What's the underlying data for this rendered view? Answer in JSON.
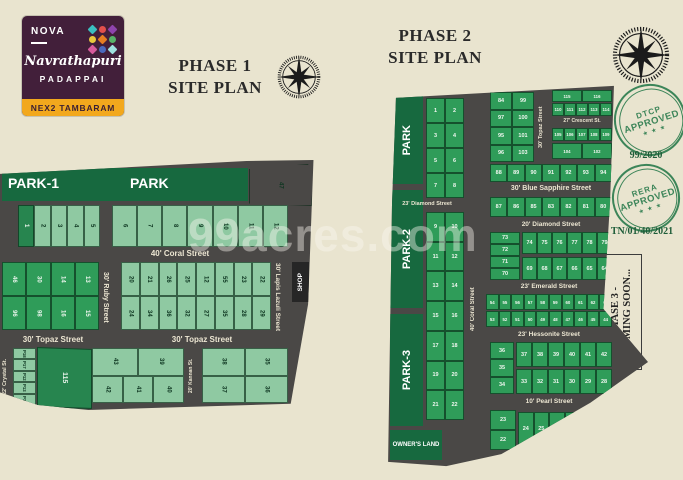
{
  "page": {
    "watermark": "99acres.com"
  },
  "colors": {
    "background": "#e9e4cf",
    "road": "#4a4846",
    "park_green": "#17693f",
    "plot_light": "#8fc9a2",
    "plot_mid": "#2f9c59",
    "plot_dark": "#27854f",
    "stamp_green": "#2e7d4f",
    "logo_bg": "#421f3a",
    "logo_banner": "#f2a81d"
  },
  "logo": {
    "brand": "NOVA",
    "name": "Navrathapuri",
    "location": "PADAPPAI",
    "banner": "NEX2 TAMBARAM",
    "gems": [
      "#3bbfc0",
      "#e2504c",
      "#8e44ad",
      "#e9c93d",
      "#e67e22",
      "#58b368",
      "#d85a9c",
      "#4a69bd",
      "#9fe3e0"
    ]
  },
  "titles": {
    "phase1_line1": "PHASE 1",
    "phase1_line2": "SITE PLAN",
    "phase2_line1": "PHASE 2",
    "phase2_line2": "SITE PLAN"
  },
  "approvals": {
    "dtcp": {
      "top": "DTCP",
      "mid": "APPROVED",
      "stars": "★ ★ ★",
      "number": "99/2020"
    },
    "rera": {
      "top": "RERA",
      "mid": "APPROVED",
      "stars": "★ ★ ★",
      "number": "TN/01/40/2021"
    }
  },
  "phase3_banner": {
    "line1": "PHASE 3 -",
    "line2": "COMING SOON..."
  },
  "phase1": {
    "park1_label": "PARK-1",
    "park_label": "PARK",
    "corner_plot": "47",
    "shop_label": "SHOP",
    "streets": {
      "coral": "40' Coral Street",
      "ruby": "30' Ruby Street",
      "lapis": "30' Lapis Lazuli Street",
      "topaz": "30' Topaz Street",
      "topaz_left": "30' Topaz Street",
      "crystal": "22' Crystal St.",
      "kannan": "20' Kannan St."
    },
    "row_top_a": [
      "1",
      "2",
      "3",
      "4",
      "5"
    ],
    "row_top_b": [
      "6",
      "7",
      "8",
      "9",
      "10",
      "11",
      "12"
    ],
    "block_left": [
      [
        "46",
        "30",
        "14",
        "13"
      ],
      [
        "96",
        "98",
        "16",
        "15"
      ]
    ],
    "block_center": [
      [
        "20",
        "21",
        "26",
        "25",
        "12",
        "55",
        "23",
        "22"
      ],
      [
        "24",
        "34",
        "36",
        "32",
        "27",
        "35",
        "28",
        "29"
      ]
    ],
    "tiny_col": [
      "P18",
      "P17",
      "P12",
      "P13",
      "P14"
    ],
    "plot_115": "115",
    "block_bl": [
      [
        "43",
        "39"
      ],
      [
        "42",
        "41",
        "40"
      ]
    ],
    "block_br": [
      [
        "38",
        "35"
      ],
      [
        "37",
        "36"
      ]
    ]
  },
  "phase2": {
    "parks": [
      "PARK",
      "PARK-2",
      "PARK-3"
    ],
    "owners_land": "OWNER'S LAND",
    "shop_label": "SHOP",
    "streets": {
      "topaz": "30' Topaz Street",
      "crescent": "27' Crescent St.",
      "blue_sapphire": "30' Blue Sapphire Street",
      "diamond_small": "23' Diamond Street",
      "diamond": "20' Diamond Street",
      "emerald": "23' Emerald Street",
      "hessonite": "23' Hessonite Street",
      "pearl": "10' Pearl Street",
      "coral": "40' Coral Street"
    },
    "col_left_upper": [
      [
        "1",
        "2"
      ],
      [
        "3",
        "4"
      ],
      [
        "5",
        "6"
      ],
      [
        "7",
        "8"
      ]
    ],
    "col_left_lower": [
      [
        "9",
        "10"
      ],
      [
        "11",
        "12"
      ],
      [
        "13",
        "14"
      ],
      [
        "15",
        "16"
      ],
      [
        "17",
        "18"
      ],
      [
        "19",
        "20"
      ],
      [
        "21",
        "22"
      ]
    ],
    "block_top_left": [
      [
        "84",
        "99"
      ],
      [
        "97",
        "100"
      ],
      [
        "95",
        "101"
      ],
      [
        "96",
        "103"
      ]
    ],
    "row_115": [
      "115",
      "116"
    ],
    "row_110": [
      "110",
      "111",
      "112",
      "113",
      "114"
    ],
    "row_105": [
      "105",
      "106",
      "107",
      "108",
      "109"
    ],
    "row_104": [
      "104",
      "102"
    ],
    "row_88": [
      "88",
      "89",
      "90",
      "91",
      "92",
      "93",
      "94"
    ],
    "row_80": [
      "87",
      "86",
      "85",
      "83",
      "82",
      "81",
      "80"
    ],
    "col_70": [
      "73",
      "72",
      "71",
      "70"
    ],
    "row_74": [
      "74",
      "75",
      "76",
      "77",
      "78",
      "79"
    ],
    "row_64": [
      "69",
      "68",
      "67",
      "66",
      "65",
      "64"
    ],
    "row_54": [
      "54",
      "55",
      "56",
      "57",
      "58",
      "59",
      "60",
      "61",
      "62",
      "63"
    ],
    "row_44": [
      "53",
      "52",
      "51",
      "50",
      "49",
      "48",
      "47",
      "46",
      "45",
      "44"
    ],
    "col_34": [
      "36",
      "35",
      "34"
    ],
    "row_37": [
      "37",
      "38",
      "39",
      "40",
      "41",
      "42"
    ],
    "row_28": [
      "33",
      "32",
      "31",
      "30",
      "29",
      "28"
    ],
    "col_22": [
      "23",
      "22"
    ],
    "row_24": [
      "24",
      "25",
      "26",
      "27"
    ]
  }
}
